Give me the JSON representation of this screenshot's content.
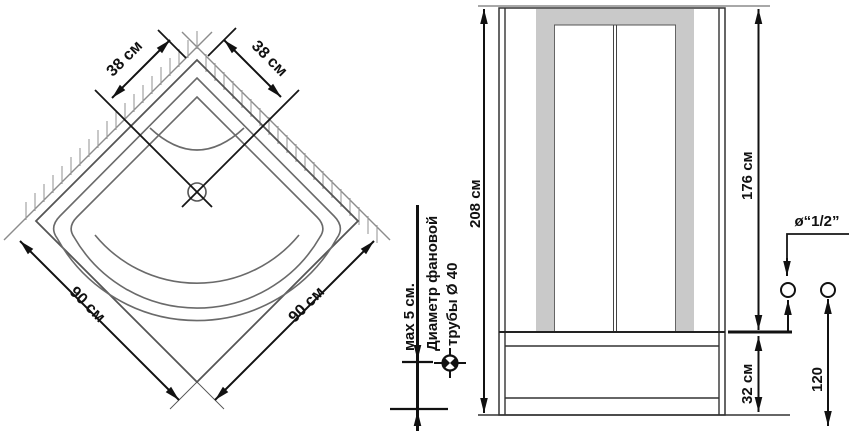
{
  "title": "Схема установки душевой кабины",
  "colors": {
    "background": "#ffffff",
    "line": "#333333",
    "dimension": "#111111",
    "wall": "#8c8c8c",
    "panel_gray": "#c9c9c9"
  },
  "top_view": {
    "dim_side_left": "38 см",
    "dim_side_right": "38 см",
    "dim_width_left": "90 см",
    "dim_width_right": "90 см"
  },
  "drain_detail": {
    "max_distance": "мах 5 см.",
    "pipe_note_line1": "Диаметр фановой",
    "pipe_note_line2": "трубы Ø 40"
  },
  "front_view": {
    "total_height": "208 см",
    "door_height": "176 см",
    "tray_height": "32 см"
  },
  "connection": {
    "fitting_size": "ø“1/2”",
    "spacing": "120"
  }
}
